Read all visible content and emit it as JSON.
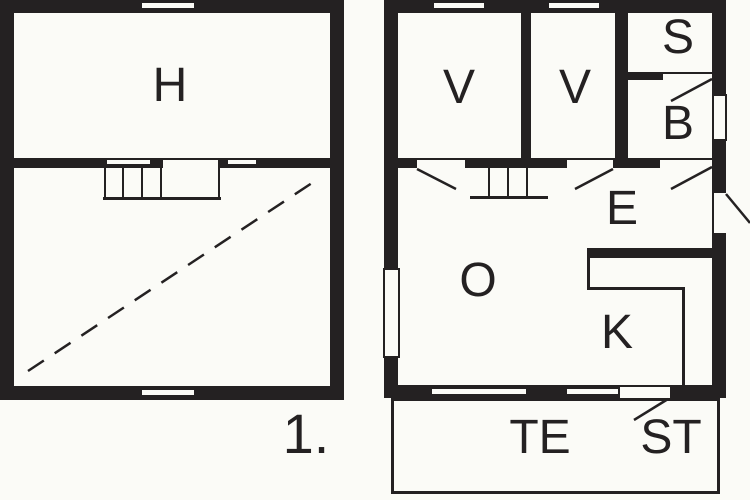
{
  "floor_label": "1.",
  "rooms": {
    "h": "H",
    "v1": "V",
    "v2": "V",
    "s": "S",
    "b": "B",
    "e": "E",
    "o": "O",
    "k": "K",
    "te": "TE",
    "st": "ST"
  },
  "colors": {
    "wall": "#242122",
    "background": "#fbfbf7"
  }
}
